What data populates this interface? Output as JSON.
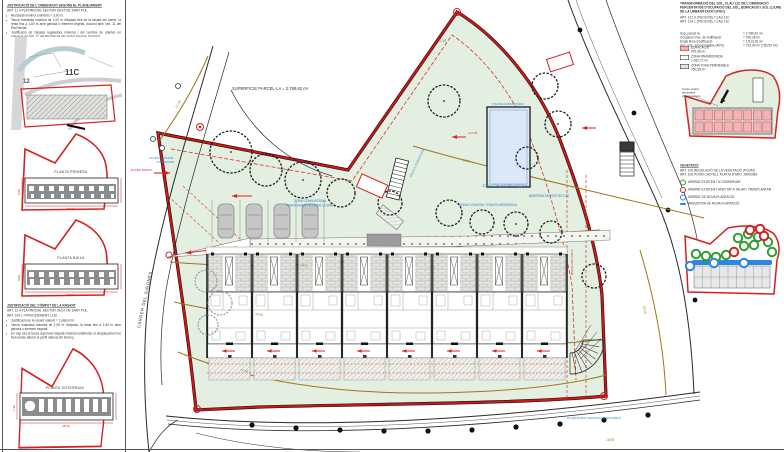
{
  "left_panel": {
    "note_a": {
      "title": "JUSTIFICACIÓ DE L'ORDENACIÓ SEGONS EL PLANEJAMENT",
      "art": "ART. 11.4 PLA PARCIAL SECTOR OEST DE SANT POL.",
      "bullets": [
        "Reculada mínima a llindars = 3,00 m.",
        "Tanca massissa màxima de 1,00 m d'alçada des de la rasant del carrer; la resta fins a 1,80 m amb gelosia o element vegetal, d'acord amb l'art. 11 del Pla Parcial.",
        "Justificació de l'alçada reguladora màxima i del nombre de plantes en aplicació de l'art. 11 del Pla Parcial del sector Oest de Sant Pol."
      ]
    },
    "map": {
      "label_12": "12",
      "label_11c": "11C"
    },
    "plans": [
      {
        "label": "PLANTA PRIMERA",
        "dim_w": "50.04",
        "dim_h": "8.00"
      },
      {
        "label": "PLANTA BAIXA",
        "dim_w": "50.04",
        "dim_h": "8.00"
      },
      {
        "label": "PLANTA SOTERRANI",
        "dim_w": "48.10",
        "dim_h": "7.20"
      }
    ],
    "note_b": {
      "title": "JUSTIFICACIÓ DEL CÒMPUT DE LA RASANT",
      "art1": "ART. 11.4 PLA PARCIAL SECTOR OEST DE SANT POL.",
      "art2": "ART. 104.1 I PROCEDIMENT, LLEI.",
      "bullets": [
        "Justificació de la rasant natural = 1 plànol m².",
        "Tanca massissa màxima de 1,00 m d'alçada; la resta fins a 1,80 m amb gelosia o element vegetal.",
        "En cap cas la tanca superarà l'alçada màxima establerta; el desplaçament es farà sense alterar el perfil natural del terreny."
      ]
    }
  },
  "site": {
    "surface": "SUPERFÍCIE PARCEL·LA = 2.789,62 m²",
    "street": "CARRER DEL GIRONÈS",
    "labels": {
      "parking_1": "ZONA COMUNITÀRIA",
      "parking_2": "APARCAMENT A L'AIRE LLIURE",
      "pool_zone": "ZONA COMUNITÀRIA PISCINA",
      "pool": "PISCINA COMUNITÀRIA",
      "soft_zone": "ZONA COMUNAL TOVA ENJARDINADA",
      "barrier": "BARRERA DE PROTECCIÓ",
      "stair": "ESCALA COMUNITÀRIA",
      "access_ped_1": "ACCÉS PEATONAL",
      "access_ped_2": "COMUNITARI",
      "access_car_left": "ACCÉS RODAT",
      "access_car_bottom": "ACCÉS RODAT VEHICLES APARCAMENT",
      "level_1735": "+17.35",
      "setback": "RECULADA 3,00 m"
    },
    "contours": [
      "20.60",
      "19.60",
      "18.60",
      "17.60"
    ],
    "spots": [
      "21.40",
      "20.15",
      "19.10",
      "16.95"
    ]
  },
  "right_panel": {
    "title_1": "TRANSFORMACIÓ DEL SÒL. CLAU 11C DE L'ORDENACIÓ",
    "title_2": "PERCENTATGE D'OCUPACIÓ DEL SÒL, EDIFICACIÓ I SÒL LLIURE",
    "title_3": "DE LA URBANITZACIÓ (PGO)",
    "art_1": "ART. 121.3 (PGOU/06). CLAU 11C",
    "art_2": "ART. 124.1 (PGOU/06). CLAU 11C",
    "params": [
      {
        "label": "Sup. parcel·la",
        "value": "= 2.789,62 m²"
      },
      {
        "label": "Ocupació màx. de l'edificació",
        "value": "= 976,36 m²"
      },
      {
        "label": "Espai lliure d'edificació",
        "value": "= 1.813,26 m²"
      },
      {
        "label": "Sup. mín. sòl permeable (40%)",
        "value": "= 725,30 m² (750,55 m²)"
      }
    ],
    "legend": [
      {
        "label": "EDIFICACIÓ",
        "sub": "976,36 m²"
      },
      {
        "label": "ZONA PAVIMENTADA",
        "sub": "1.062,71 m²"
      },
      {
        "label": "ZONA TOVA PERMEABLE",
        "sub": "750,55 m²"
      }
    ],
    "occ_note_1": "Sostre màxim",
    "occ_note_2": "admissible",
    "occ_note_3": "s/ planejament",
    "vegetation": {
      "title": "VEGETACIÓ",
      "art_1": "ART. 105 REGULACIÓ DE LA VEGETACIÓ (POUM)",
      "art_2": "ART. 106 POUM CASTELL-PLATJA D'ARO. JARDINS",
      "items": [
        "ARBRAT EXISTENT A CONSERVAR",
        "ARBRAT EXISTENT AFECTAT A TALAR / TRASPLANTAR",
        "ARBRAT DE NOVA PLANTACIÓ",
        "ARBUSTIVA DE NOVA PLANTACIÓ"
      ]
    }
  }
}
